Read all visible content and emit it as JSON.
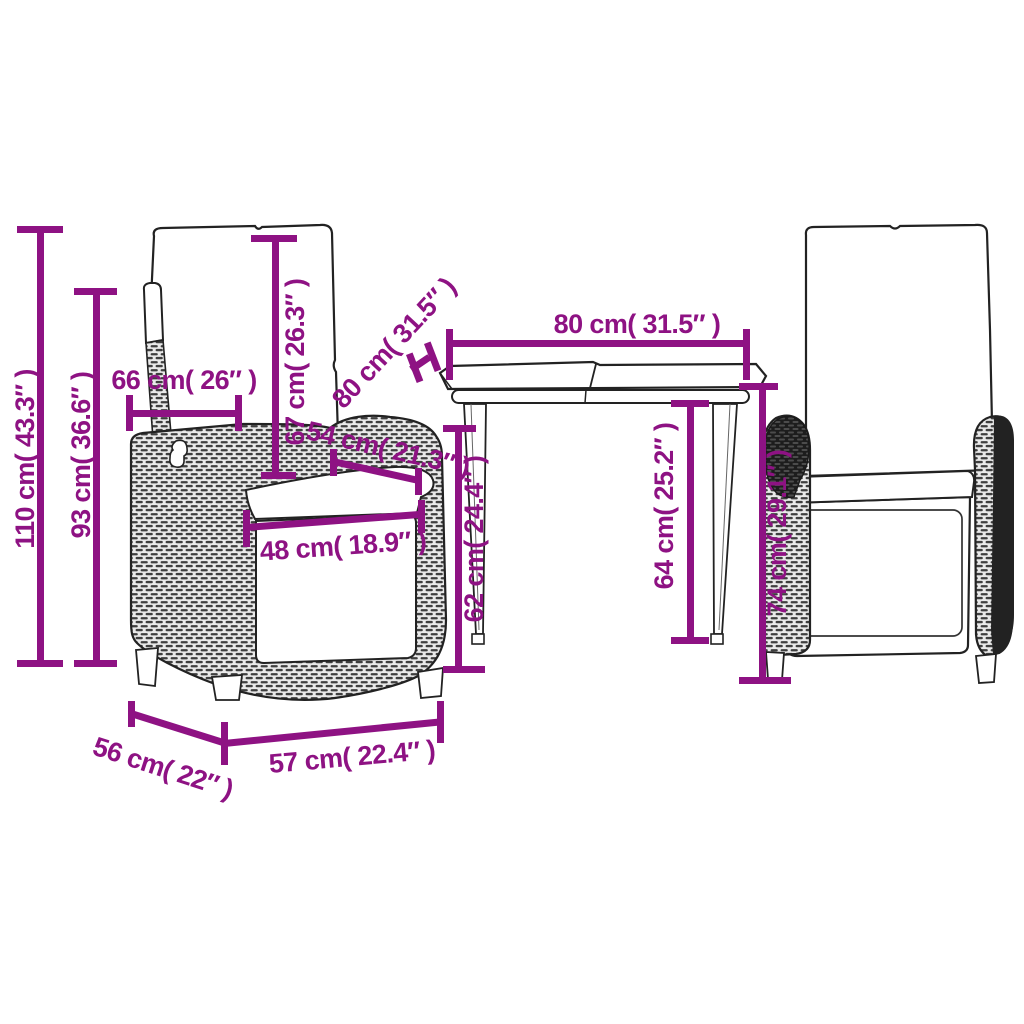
{
  "ui": {
    "accent_color": "#8e1283",
    "line_color": "#222222",
    "background": "#ffffff"
  },
  "measurements": {
    "chair_total_height": "110 cm( 43.3″ )",
    "chair_backrest_height": "93 cm( 36.6″ )",
    "chair_back_width": "66 cm( 26″ )",
    "back_cushion_height": "67 cm( 26.3″ )",
    "armrest_length": "54 cm( 21.3″ )",
    "seat_width": "48 cm( 18.9″ )",
    "table_top_width": "80 cm( 31.5″ )",
    "table_top_depth": "80 cm( 31.5″ )",
    "table_height_left": "62 cm( 24.4″ )",
    "table_height_right": "64 cm( 25.2″ )",
    "armrest_height": "74 cm( 29.1″ )",
    "chair_base_depth": "56 cm( 22″ )",
    "chair_base_width": "57 cm( 22.4″ )"
  }
}
